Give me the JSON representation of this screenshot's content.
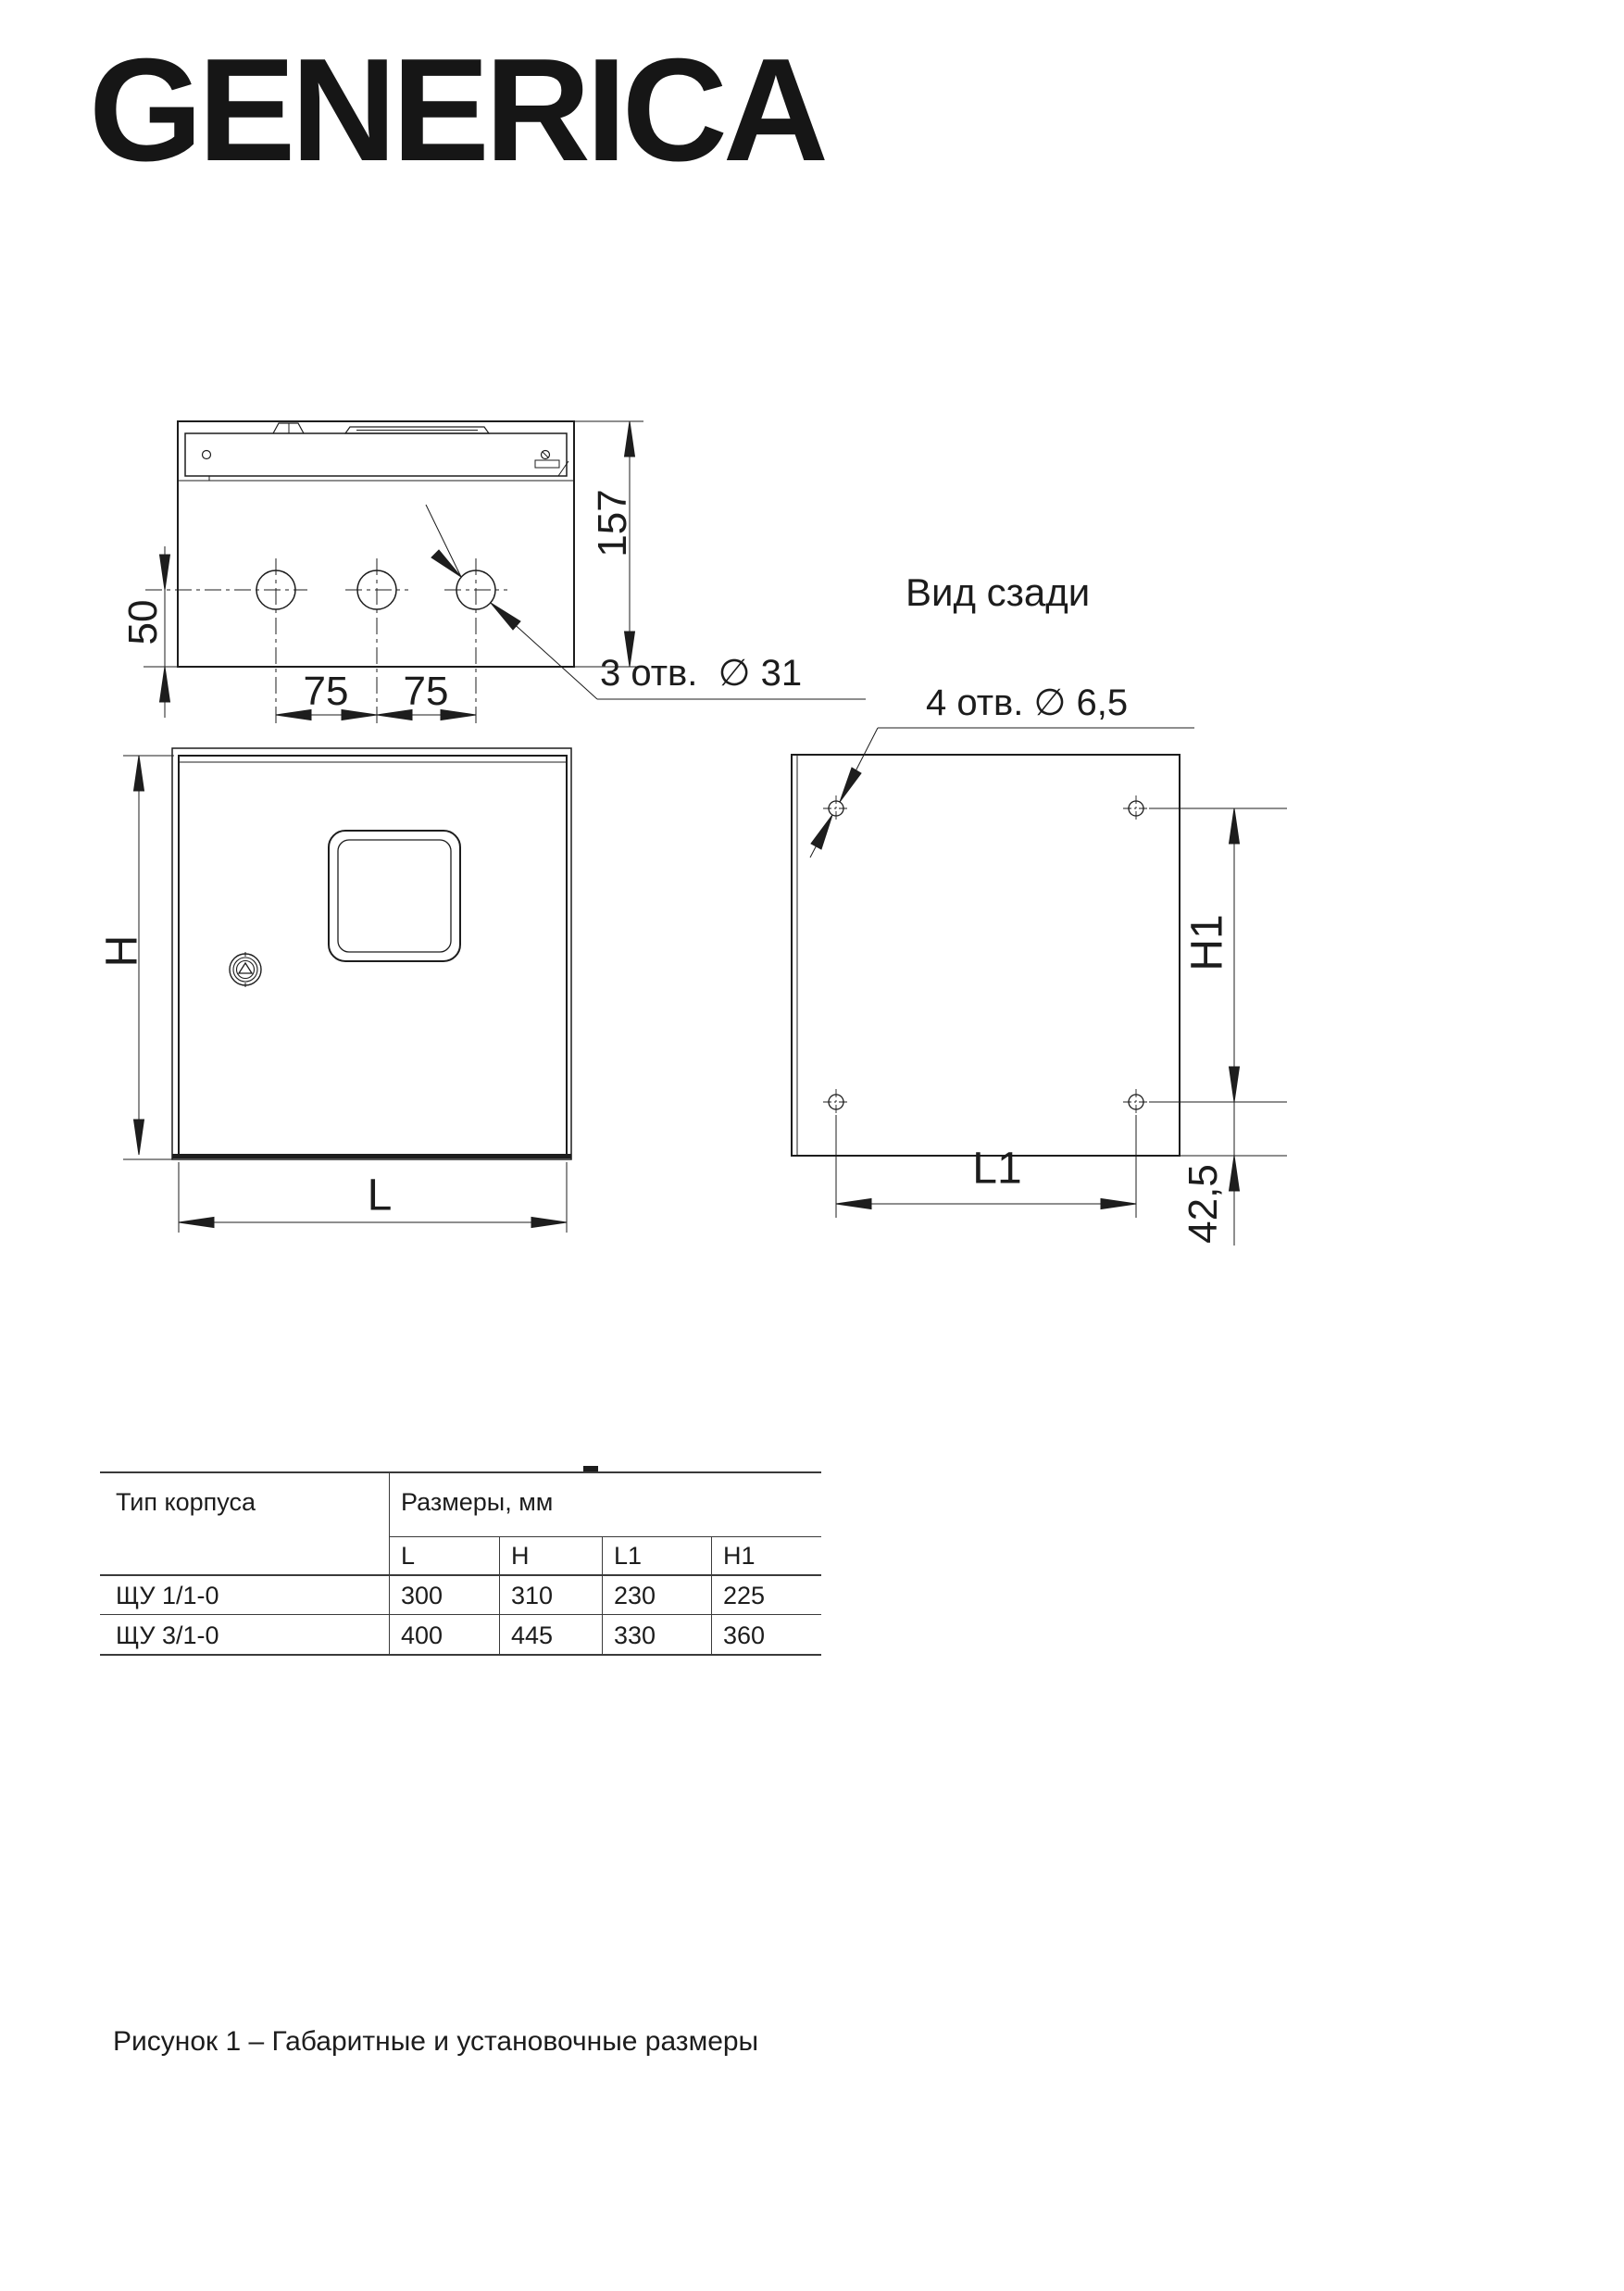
{
  "brand": {
    "logo_text": "GENERICA"
  },
  "drawing": {
    "top_view": {
      "depth_dim": "157",
      "hole_offset_dim": "50",
      "hole_pitch_dim_1": "75",
      "hole_pitch_dim_2": "75",
      "holes_note": "3 отв.  ∅ 31"
    },
    "front_view": {
      "height_dim": "H",
      "width_dim": "L"
    },
    "rear_view": {
      "title": "Вид сзади",
      "holes_note": "4 отв. ∅ 6,5",
      "height_dim": "H1",
      "width_dim": "L1",
      "bottom_offset_dim": "42,5"
    }
  },
  "table": {
    "col_type_header": "Тип корпуса",
    "col_dims_header": "Размеры, мм",
    "sub_headers": [
      "L",
      "H",
      "L1",
      "H1"
    ],
    "rows": [
      {
        "type": "ЩУ 1/1-0",
        "values": [
          "300",
          "310",
          "230",
          "225"
        ]
      },
      {
        "type": "ЩУ 3/1-0",
        "values": [
          "400",
          "445",
          "330",
          "360"
        ]
      }
    ]
  },
  "caption": "Рисунок 1 – Габаритные и установочные размеры",
  "colors": {
    "ink": "#1d1d1d",
    "paper": "#ffffff"
  }
}
